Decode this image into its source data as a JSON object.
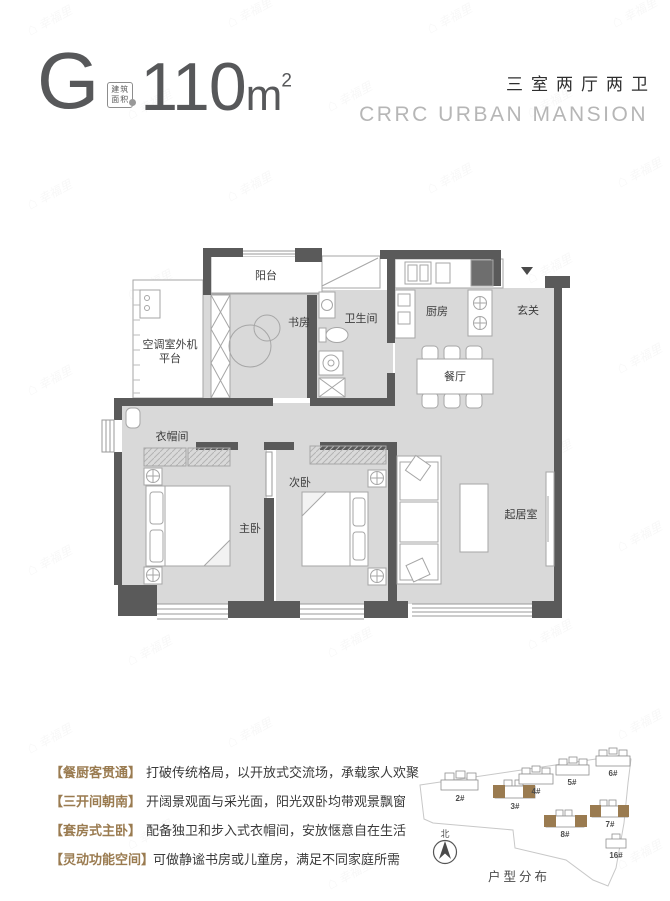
{
  "watermark": {
    "text": "幸福里"
  },
  "header": {
    "unit_letter": "G",
    "area_badge": {
      "line1": "建筑",
      "line2": "面积"
    },
    "area_value": "110",
    "area_unit": "m",
    "area_sup": "2",
    "layout_summary": "三室两厅两卫",
    "project_name": "CRRC URBAN MANSION"
  },
  "floorplan": {
    "rooms": {
      "balcony": "阳台",
      "study": "书房",
      "bathroom": "卫生间",
      "kitchen": "厨房",
      "entry": "玄关",
      "dining": "餐厅",
      "ac_platform_line1": "空调室外机",
      "ac_platform_line2": "平台",
      "cloakroom": "衣帽间",
      "master_bedroom": "主卧",
      "second_bedroom": "次卧",
      "living_room": "起居室"
    }
  },
  "features": [
    {
      "tag": "【餐厨客贯通】",
      "desc": "打破传统格局，以开放式交流场，承载家人欢聚"
    },
    {
      "tag": "【三开间朝南】",
      "desc": "开阔景观面与采光面，阳光双卧均带观景飘窗"
    },
    {
      "tag": "【套房式主卧】",
      "desc": "配备独卫和步入式衣帽间，安放惬意自在生活"
    },
    {
      "tag": "【灵动功能空间】",
      "desc": "可做静谧书房或儿童房，满足不同家庭所需"
    }
  ],
  "siteplan": {
    "caption": "户型分布",
    "north_label": "北",
    "buildings": [
      {
        "label": "2#",
        "highlighted": false
      },
      {
        "label": "3#",
        "highlighted": true
      },
      {
        "label": "4#",
        "highlighted": false
      },
      {
        "label": "5#",
        "highlighted": false
      },
      {
        "label": "6#",
        "highlighted": false
      },
      {
        "label": "7#",
        "highlighted": true
      },
      {
        "label": "8#",
        "highlighted": true
      },
      {
        "label": "16#",
        "highlighted": false
      }
    ],
    "highlight_color": "#9a7b50"
  },
  "colors": {
    "accent_gold": "#9a7b50",
    "wall": "#5a5a5a",
    "floor": "#d9d9d9",
    "project_name_gray": "#b6b6b6"
  }
}
